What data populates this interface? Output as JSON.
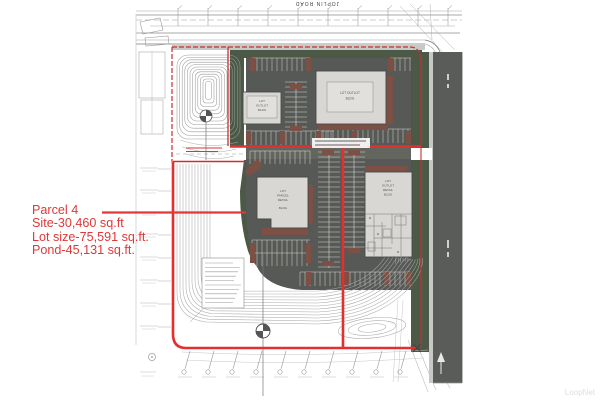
{
  "annotation": {
    "title": "Parcel 4",
    "site_line": "Site-30,460 sq.ft",
    "lot_line": "Lot size-75,591 sq.ft.",
    "pond_line": "Pond-45,131 sq.ft."
  },
  "roads": {
    "top_road_label": "JOPLIN ROAD"
  },
  "buildings": {
    "outlot_a": {
      "lines": [
        "LOT",
        "OUTLOT",
        "BLDG"
      ]
    },
    "outlot_b": {
      "lines": [
        "LOT OUTLOT",
        "BLDG"
      ]
    },
    "parcel4": {
      "lines": [
        "LOT",
        "PARCEL",
        "RETAIL",
        "BLDG"
      ]
    },
    "east": {
      "lines": [
        "LOT",
        "OUTLOT",
        "RETAIL",
        "BLDG"
      ]
    }
  },
  "watermark": "LoopNet",
  "colors": {
    "annotation_red": "#e23737",
    "boundary_red": "#cc2f2f",
    "parking_gray": "#565955",
    "landscape_green": "#4c5947",
    "building_gray": "#d8d7d3",
    "roof_brown": "#7c5044"
  }
}
